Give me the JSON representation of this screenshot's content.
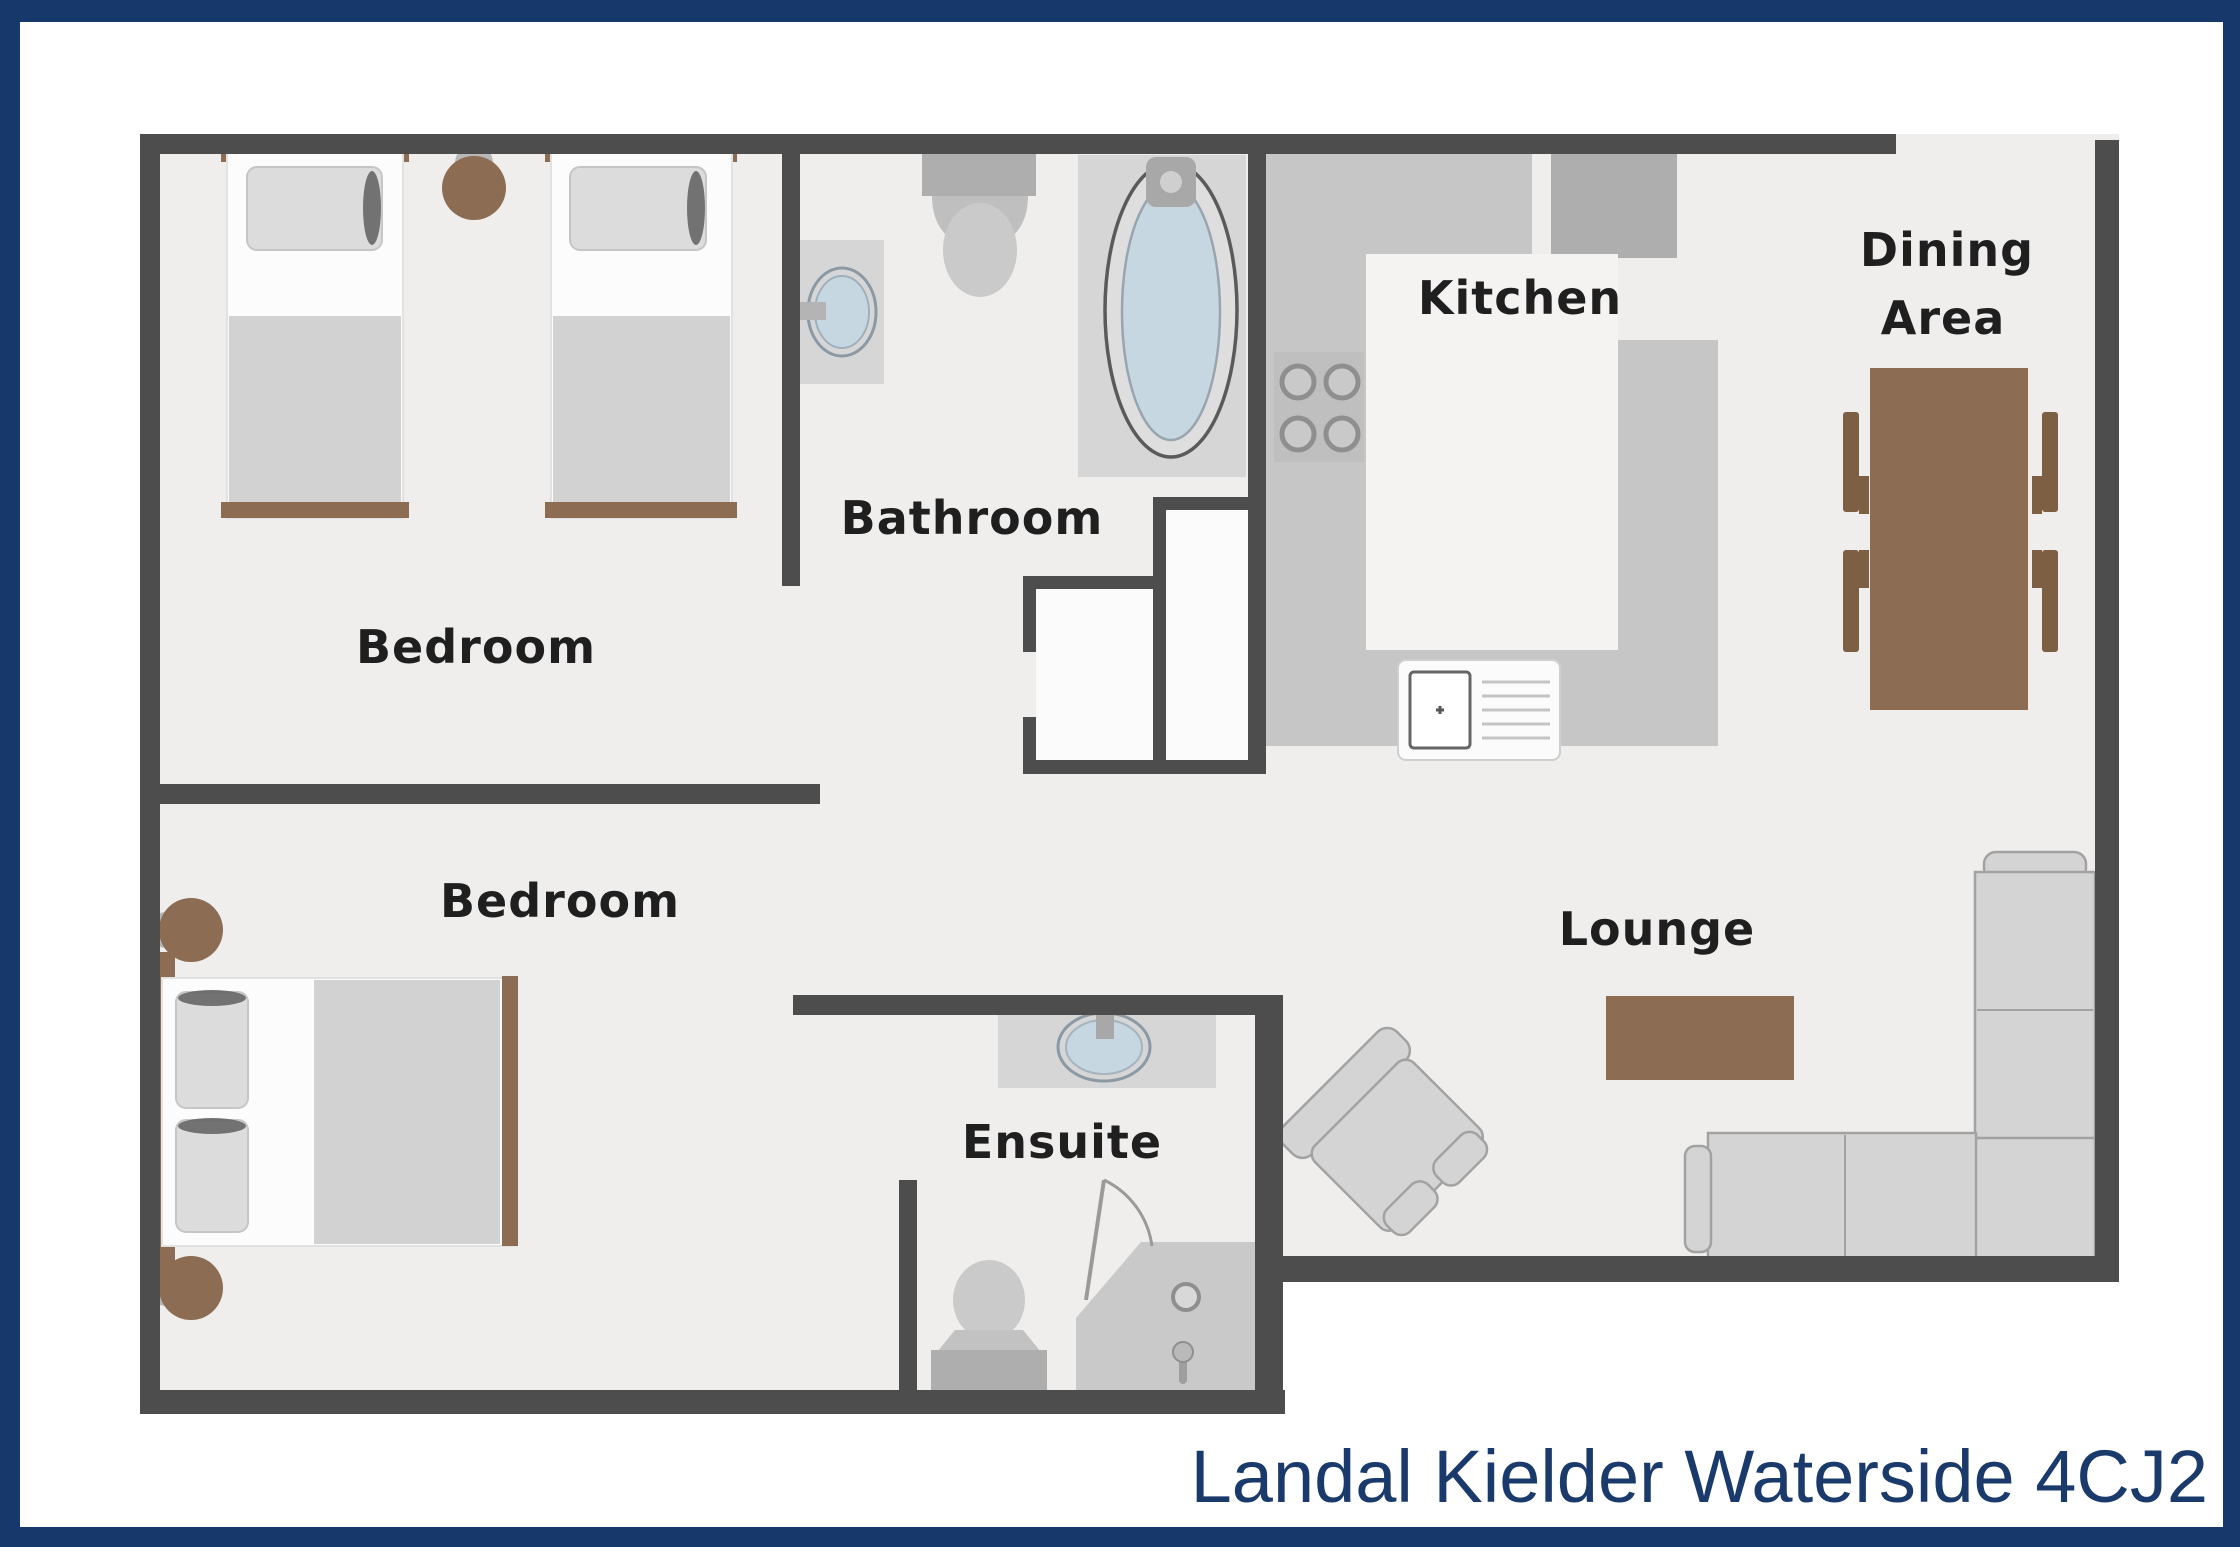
{
  "page": {
    "caption": "Landal Kielder Waterside 4CJ2"
  },
  "rooms": {
    "bedroom_top": {
      "label": "Bedroom"
    },
    "bathroom": {
      "label": "Bathroom"
    },
    "kitchen": {
      "label": "Kitchen"
    },
    "dining_area": {
      "label_line1": "Dining",
      "label_line2": "Area"
    },
    "bedroom_bottom": {
      "label": "Bedroom"
    },
    "lounge": {
      "label": "Lounge"
    },
    "ensuite": {
      "label": "Ensuite"
    }
  },
  "colors": {
    "frame_navy": "#16386B",
    "caption_navy": "#1A3A6C",
    "wall_gray": "#4D4D4D",
    "floor_gray": "#EFEEED",
    "label_text": "#1F1F1F",
    "wood_brown": "#8C6C52",
    "chair_brown": "#7D6044",
    "water_blue": "#C7D7E2",
    "page_white": "#FFFFFF"
  }
}
